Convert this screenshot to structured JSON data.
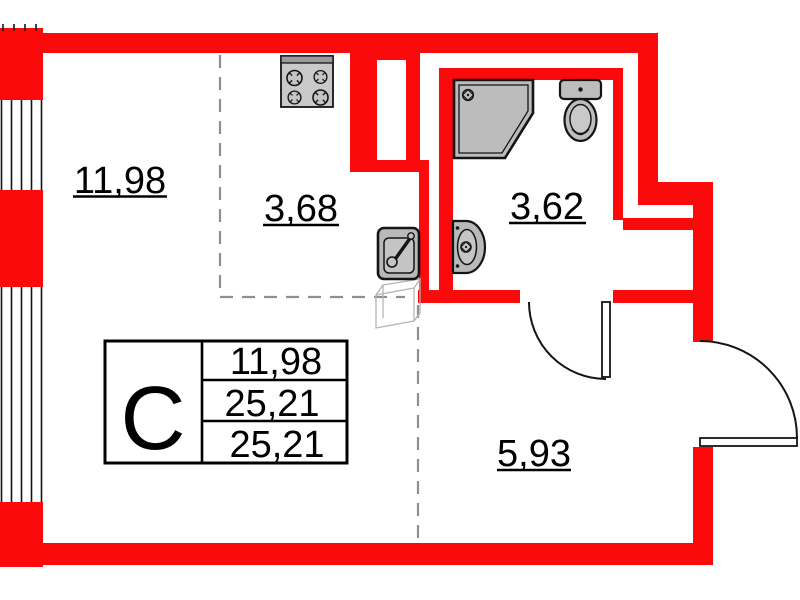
{
  "plan": {
    "unit_type_label": "C",
    "rooms": [
      {
        "id": "living-room",
        "area": "11,98"
      },
      {
        "id": "kitchen",
        "area": "3,68"
      },
      {
        "id": "bathroom",
        "area": "3,62"
      },
      {
        "id": "hallway",
        "area": "5,93"
      }
    ],
    "info_table": {
      "type_label": "C",
      "rows": [
        {
          "value": "11,98"
        },
        {
          "value": "25,21"
        },
        {
          "value": "25,21"
        }
      ]
    },
    "fixtures": [
      "stove",
      "kitchen-sink",
      "washbasin",
      "shower",
      "toilet"
    ],
    "colors": {
      "wall_red": "#fa0a0a",
      "fixture_gray": "#bdbdbd",
      "outline_black": "#141414",
      "dashed_gray": "#8f8f8f"
    }
  }
}
